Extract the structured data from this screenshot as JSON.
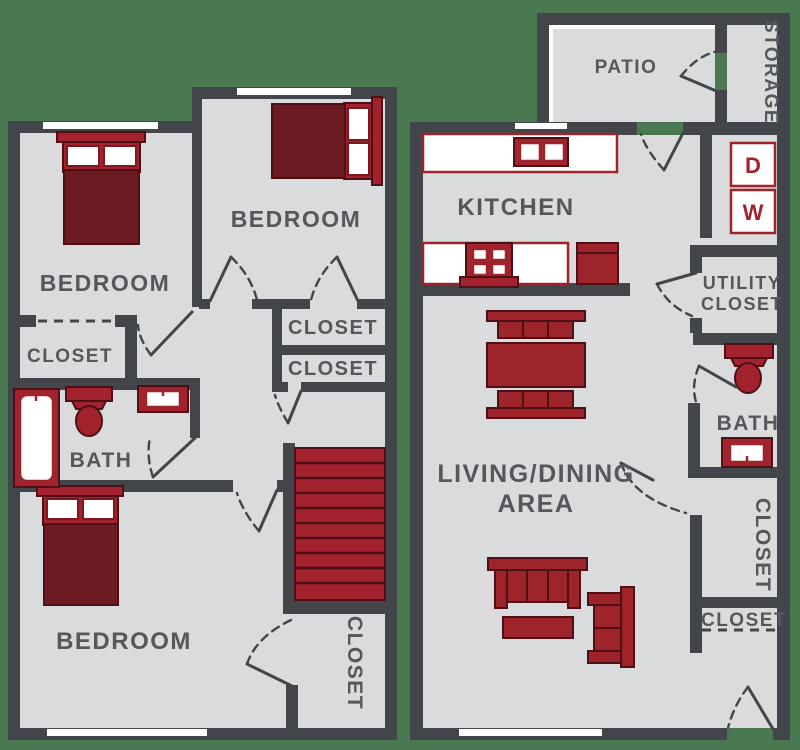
{
  "floor_plan": {
    "colors": {
      "background": "#4a7951",
      "wall": "#42464a",
      "floor": "#d9dbdc",
      "furniture_red": "#9e242b",
      "furniture_dark_maroon": "#6d1b23",
      "accent_red": "#a2232e",
      "label_gray": "#54585c",
      "window_white": "#ffffff"
    },
    "upper_floor": {
      "bedroom_top_left": "BEDROOM",
      "bedroom_top_right": "BEDROOM",
      "bedroom_bottom": "BEDROOM",
      "closet_side": "CLOSET",
      "closet_hall_top": "CLOSET",
      "closet_hall_bottom": "CLOSET",
      "bath": "BATH",
      "closet_under_stairs": "CLOSET"
    },
    "lower_floor": {
      "patio": "PATIO",
      "storage": "STORAGE",
      "kitchen": "KITCHEN",
      "dryer": "D",
      "washer": "W",
      "utility_closet_line1": "UTILITY",
      "utility_closet_line2": "CLOSET",
      "bath": "BATH",
      "closet_hall": "CLOSET",
      "closet_entry": "CLOSET",
      "living_dining_line1": "LIVING/DINING",
      "living_dining_line2": "AREA"
    }
  }
}
